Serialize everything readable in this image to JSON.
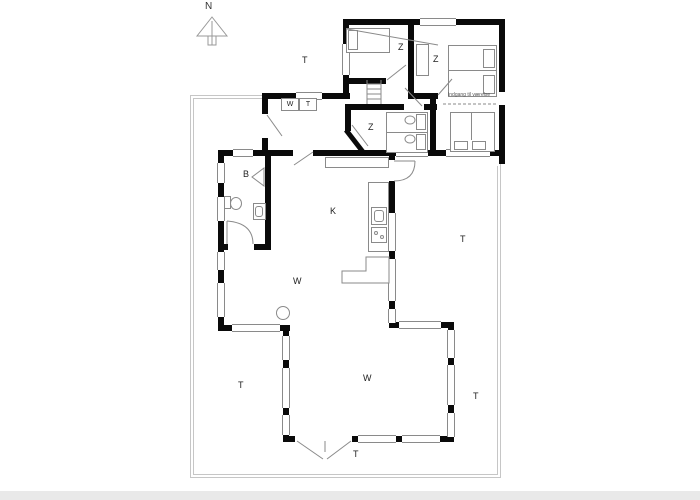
{
  "compass": {
    "label": "N"
  },
  "labels": {
    "bedroom1": "Z",
    "bedroom2": "Z",
    "bedroom3": "Z",
    "bathroom": "B",
    "kitchen": "K",
    "living_upper": "W",
    "living_lower": "W",
    "washer": "W",
    "dryer": "T",
    "terrace_top": "T",
    "terrace_right": "T",
    "terrace_bottom_left": "T",
    "terrace_bottom_right": "T",
    "terrace_bottom_center": "T",
    "annex_entrance": "Indgang til værelse"
  },
  "colors": {
    "wall": "#0a0a0a",
    "window_line": "#8a8a8a",
    "furniture_line": "#8a8a8a",
    "boundary_line": "#c6c6c6",
    "footer": "#e9e9e9",
    "background": "#ffffff"
  }
}
